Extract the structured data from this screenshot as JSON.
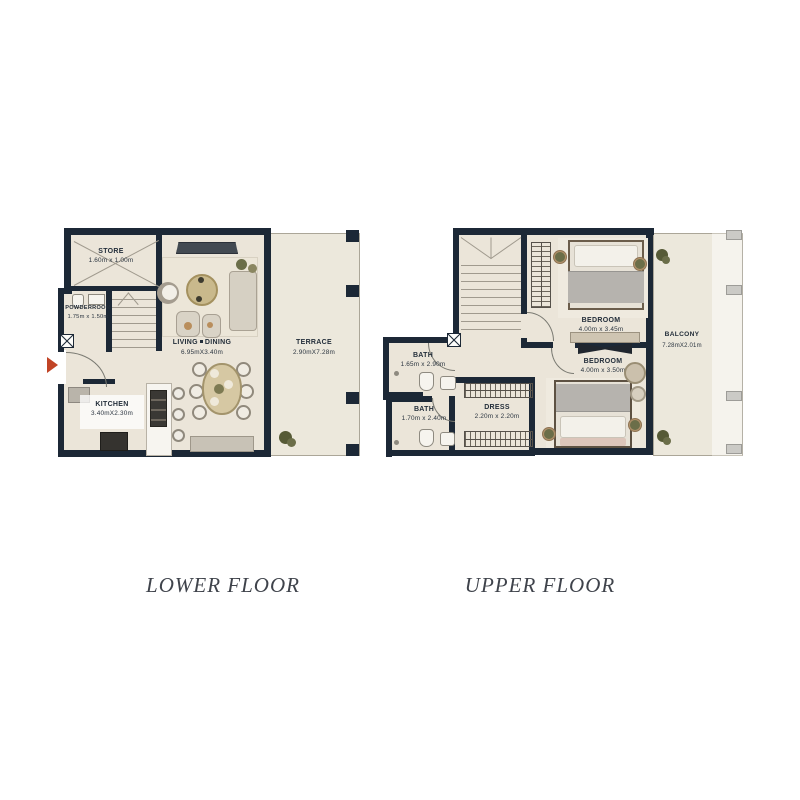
{
  "palette": {
    "wall": "#1c2836",
    "floor": "#ebe5d9",
    "terrace_floor": "#ece8dc",
    "entrance_arrow": "#c14426",
    "label_text": "#232e3a",
    "title_text": "#3f434b"
  },
  "lower": {
    "title": "LOWER FLOOR",
    "store": {
      "name": "STORE",
      "dims": "1.60m x 1.00m"
    },
    "powder": {
      "name": "POWDERROOM",
      "dims": "1.75m x 1.50m"
    },
    "living": {
      "name_left": "LIVING",
      "name_right": "DINING",
      "dims": "6.95mX3.40m"
    },
    "kitchen": {
      "name": "KITCHEN",
      "dims": "3.40mX2.30m"
    },
    "terrace": {
      "name": "TERRACE",
      "dims": "2.90mX7.28m"
    }
  },
  "upper": {
    "title": "UPPER FLOOR",
    "bath_top": {
      "name": "BATH",
      "dims": "1.65m x 2.90m"
    },
    "bath_bottom": {
      "name": "BATH",
      "dims": "1.70m x 2.40m"
    },
    "dress": {
      "name": "DRESS",
      "dims": "2.20m x 2.20m"
    },
    "bedroom_top": {
      "name": "BEDROOM",
      "dims": "4.00m x 3.45m"
    },
    "bedroom_bottom": {
      "name": "BEDROOM",
      "dims": "4.00m x 3.50m"
    },
    "balcony": {
      "name": "BALCONY",
      "dims": "7.28mX2.01m"
    }
  }
}
